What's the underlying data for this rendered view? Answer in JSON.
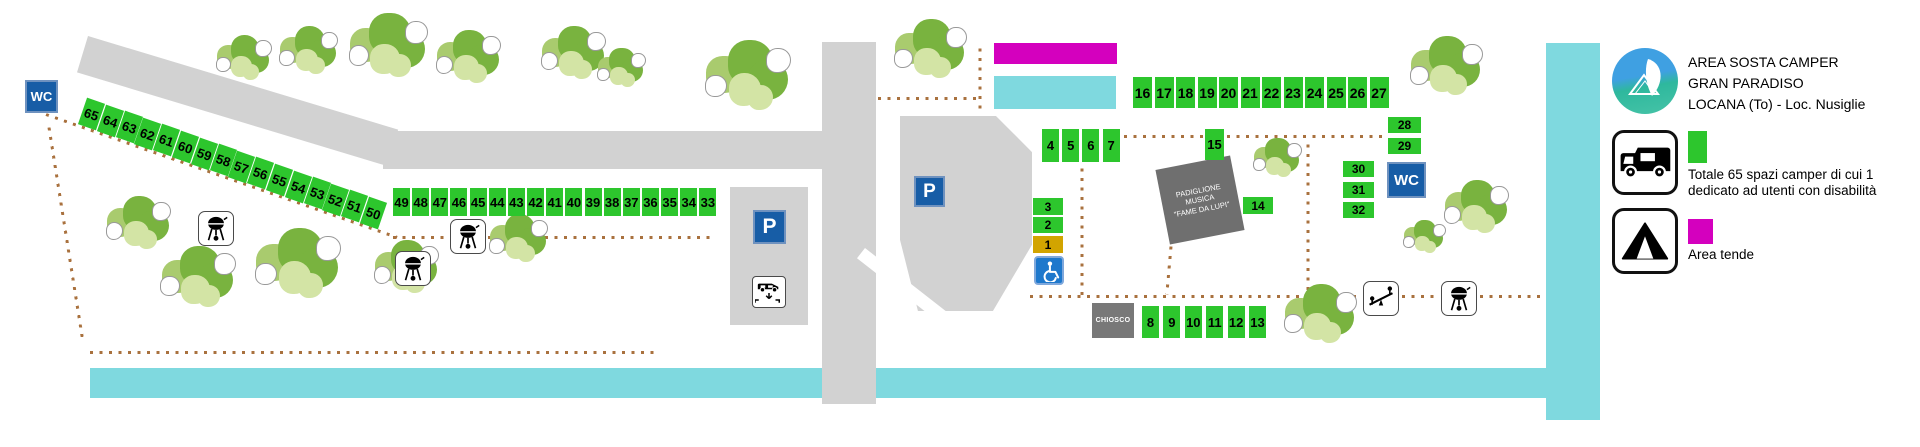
{
  "colors": {
    "spot_green": "#2DC62D",
    "spot_reserved_yellow": "#D2A400",
    "area_tende_magenta": "#D400BE",
    "water_cyan": "#7FD9DF",
    "road_gray": "#D2D2D2",
    "sign_blue": "#175DA6",
    "accessible_blue": "#1E78CC",
    "path_dot_brown": "#A9713E",
    "building_gray": "#6F6F6F"
  },
  "legend": {
    "title_lines": [
      "AREA SOSTA CAMPER",
      "GRAN PARADISO",
      "LOCANA (To) - Loc. Nusiglie"
    ],
    "camper_note_lines": [
      "Totale 65 spazi camper di cui 1",
      "dedicato ad utenti con disabilità"
    ],
    "tent_label": "Area tende"
  },
  "map": {
    "wc_label": "WC",
    "parking_label": "P",
    "kiosk_label": "CHIOSCO",
    "pavilion_lines": [
      "PADIGLIONE",
      "MUSICA",
      "\"FAME DA LUPI\""
    ],
    "spots": {
      "diagonal_65_50": [
        "65",
        "64",
        "63",
        "62",
        "61",
        "60",
        "59",
        "58",
        "57",
        "56",
        "55",
        "54",
        "53",
        "52",
        "51",
        "50"
      ],
      "row_49_33": [
        "49",
        "48",
        "47",
        "46",
        "45",
        "44",
        "43",
        "42",
        "41",
        "40",
        "39",
        "38",
        "37",
        "36",
        "35",
        "34",
        "33"
      ],
      "row_16_27": [
        "16",
        "17",
        "18",
        "19",
        "20",
        "21",
        "22",
        "23",
        "24",
        "25",
        "26",
        "27"
      ],
      "row_4_7": [
        "4",
        "5",
        "6",
        "7"
      ],
      "row_8_13": [
        "8",
        "9",
        "10",
        "11",
        "12",
        "13"
      ],
      "col_28_29": [
        "28",
        "29"
      ],
      "col_30_32": [
        "30",
        "31",
        "32"
      ],
      "single_15": "15",
      "single_14": "14",
      "single_3": "3",
      "single_2": "2",
      "single_1": "1"
    }
  },
  "icons": {
    "wc_sign": "wc-sign",
    "parking_sign": "parking-p-sign",
    "camper_service": "camper-service-icon",
    "accessible_parking": "wheelchair-icon",
    "bbq": "bbq-grill-icon",
    "playground": "seesaw-icon",
    "tent": "tent-icon",
    "camper": "camper-icon",
    "park_logo": "gran-paradiso-logo"
  }
}
